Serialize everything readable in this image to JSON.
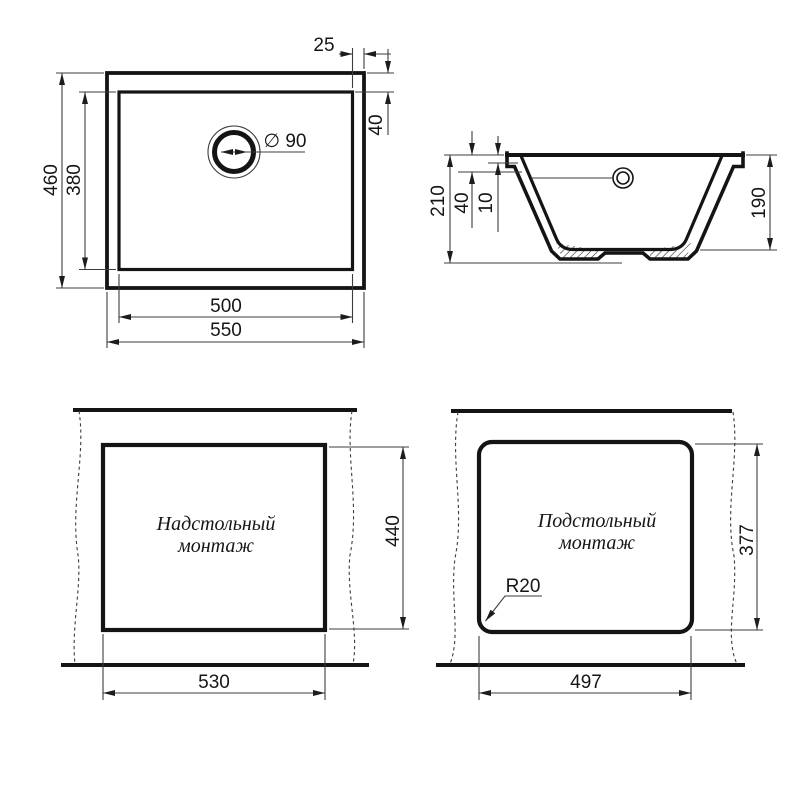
{
  "colors": {
    "ink": "#141414",
    "background": "#ffffff"
  },
  "drawing": {
    "plan": {
      "outer_width": "550",
      "inner_width": "500",
      "outer_height": "460",
      "inner_height": "380",
      "edge_offset": "25",
      "top_offset": "40",
      "drain_diameter": "∅ 90"
    },
    "section": {
      "total_height": "210",
      "offset_40": "40",
      "offset_10": "10",
      "bowl_depth": "190"
    },
    "topmount": {
      "title_line1": "Надстольный",
      "title_line2": "монтаж",
      "cutout_width": "530",
      "cutout_height": "440"
    },
    "undermount": {
      "title_line1": "Подстольный",
      "title_line2": "монтаж",
      "cutout_width": "497",
      "cutout_height": "377",
      "corner_radius": "R20"
    }
  }
}
